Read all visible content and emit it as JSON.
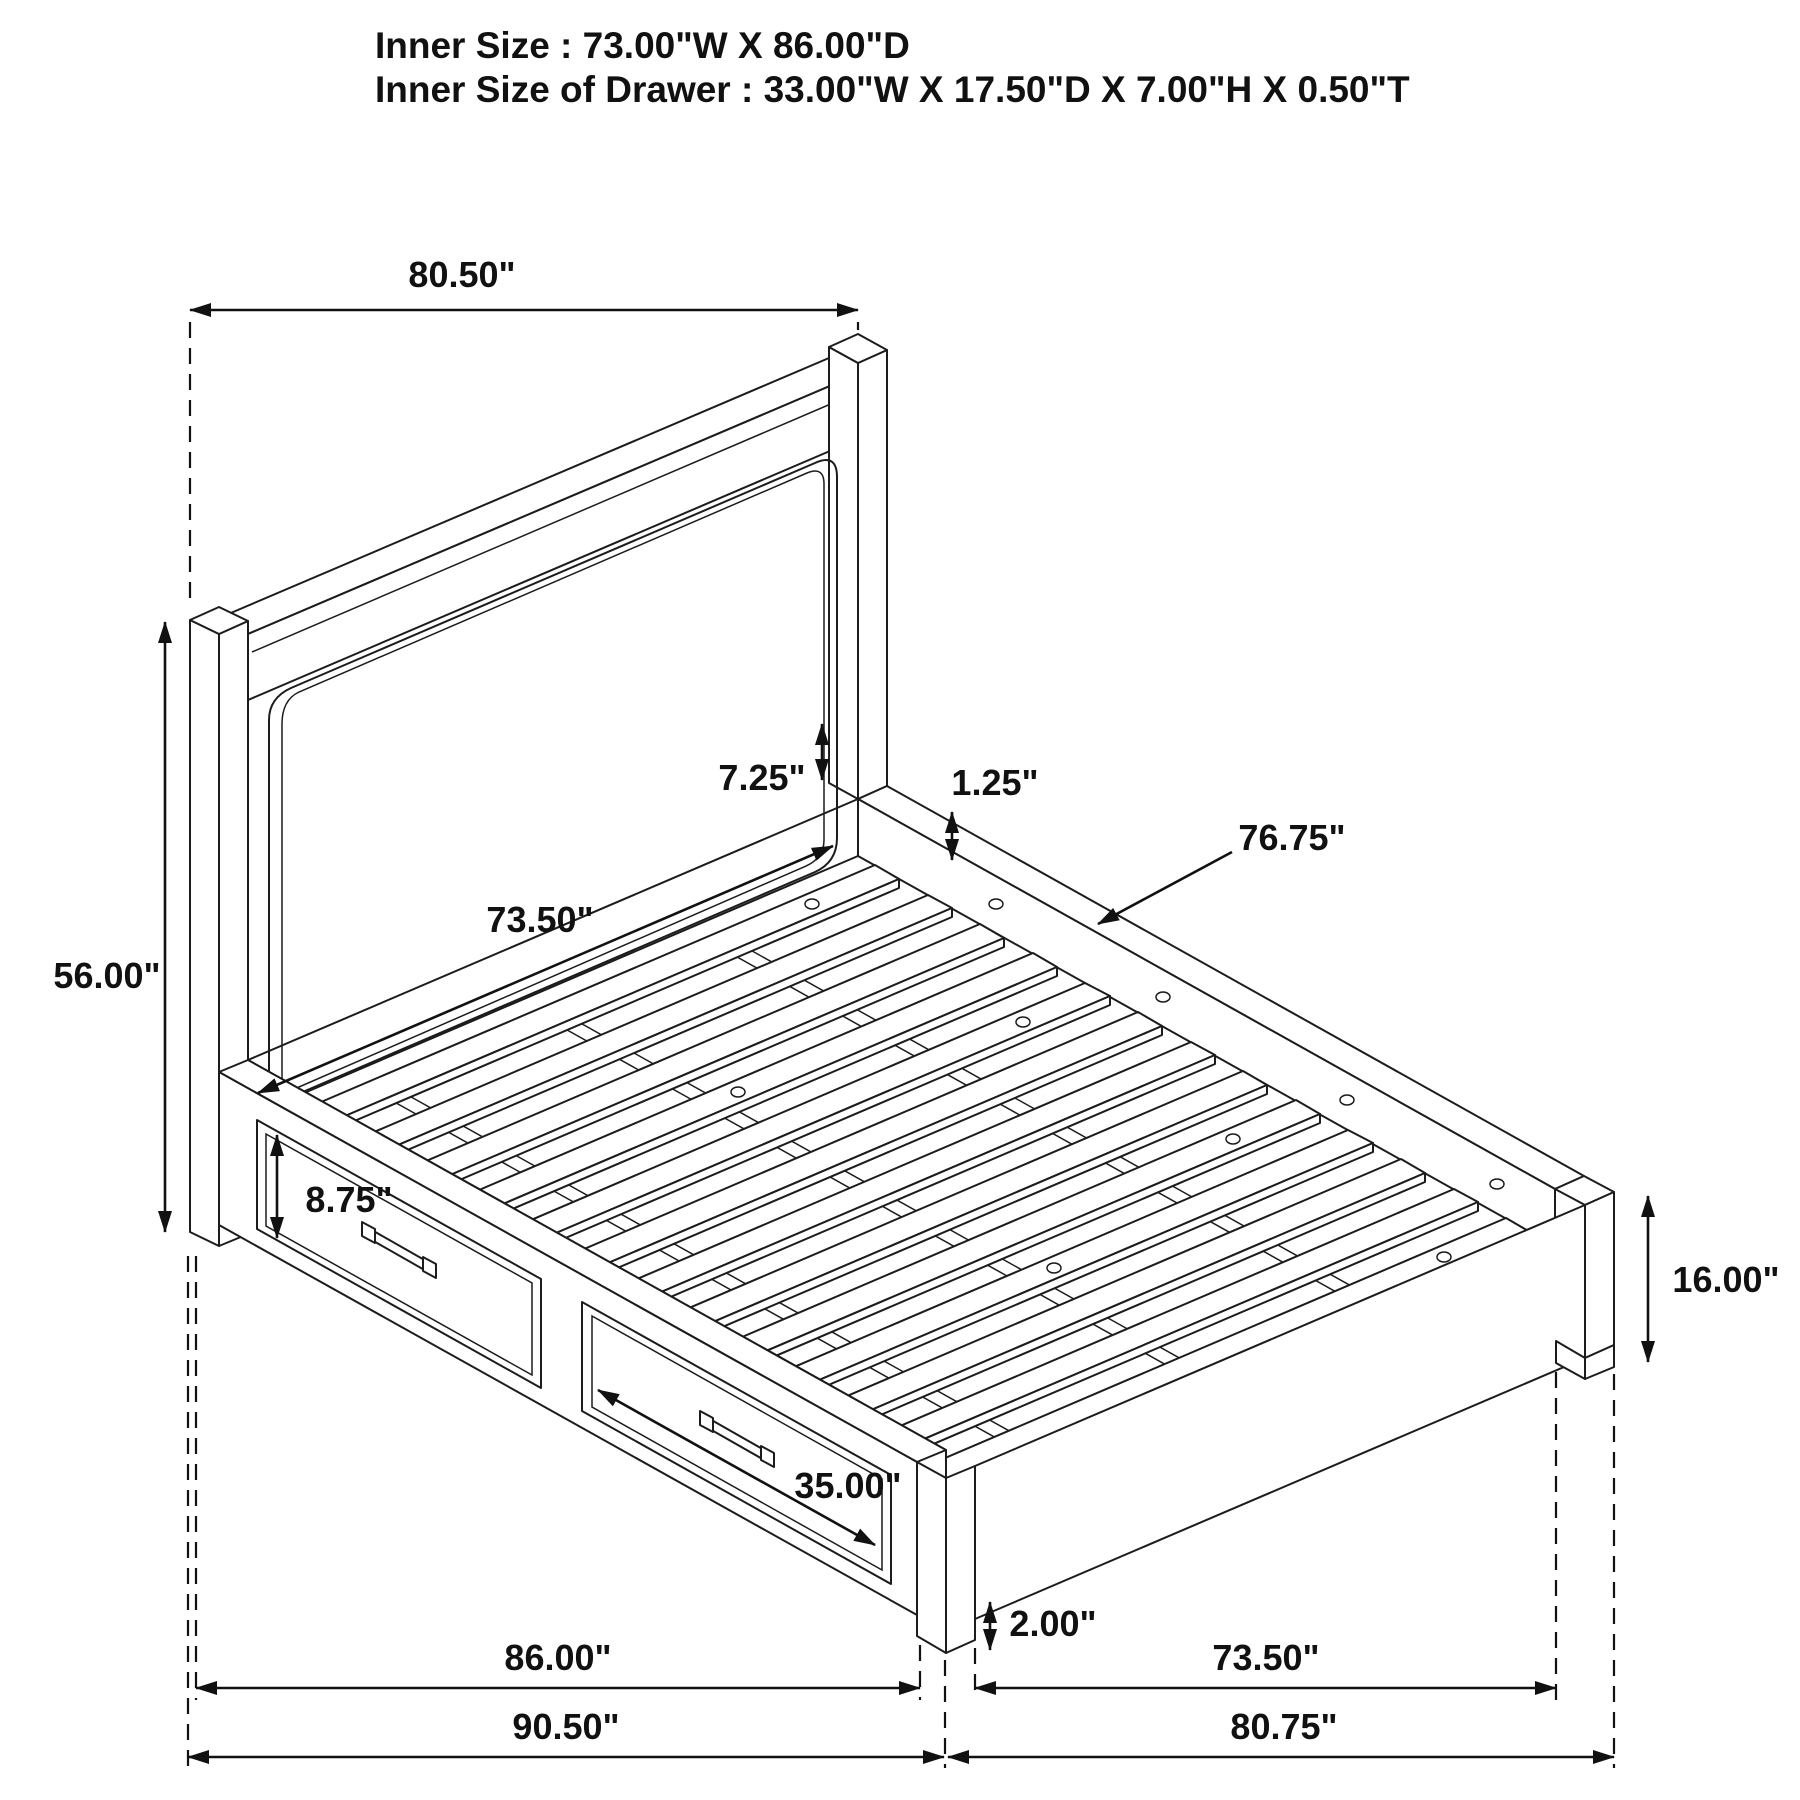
{
  "header": {
    "line1": "Inner Size : 73.00\"W X 86.00\"D",
    "line2": "Inner Size of Drawer : 33.00\"W X 17.50\"D X 7.00\"H X 0.50\"T"
  },
  "dimensions": {
    "headboard_width": "80.50\"",
    "headboard_height": "56.00\"",
    "headboard_inner_width": "73.50\"",
    "headboard_rail_gap": "7.25\"",
    "slat_thickness": "1.25\"",
    "slat_length": "76.75\"",
    "drawer_front_height": "8.75\"",
    "drawer_front_width": "35.00\"",
    "leg_reveal": "2.00\"",
    "platform_height": "16.00\"",
    "inner_depth_floor": "86.00\"",
    "overall_depth": "90.50\"",
    "inner_width_floor": "73.50\"",
    "overall_width": "80.75\""
  },
  "colors": {
    "line": "#1c1c1c",
    "background": "#ffffff"
  }
}
